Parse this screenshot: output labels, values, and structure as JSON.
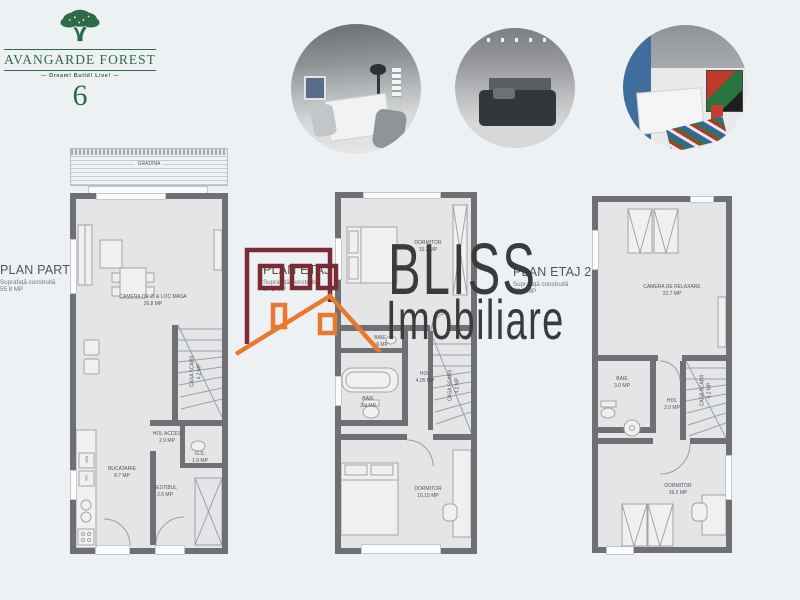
{
  "brand": {
    "name": "AVANGARDE FOREST",
    "tagline": "Dream! Build! Live!",
    "number": "6"
  },
  "watermark": {
    "title": "BLISS",
    "subtitle": "Imobiliare"
  },
  "photos": [
    {
      "alt": "living-room"
    },
    {
      "alt": "bedroom"
    },
    {
      "alt": "kids-bedroom"
    }
  ],
  "plans": [
    {
      "title": "PLAN PARTER",
      "subtitle": "Suprafață construită",
      "area": "55.8 MP",
      "garden": "GRADINA",
      "appliances": [
        "WM",
        "WV"
      ],
      "rooms": [
        {
          "label": "CAMERA DE ZI & LOC MASA",
          "area": "26.8 MP"
        },
        {
          "label": "CASA SCARII",
          "area": "4.2 MP"
        },
        {
          "label": "HOL ACCES",
          "area": "2.9 MP"
        },
        {
          "label": "G.S.",
          "area": "1.9 MP"
        },
        {
          "label": "BUCATARIE",
          "area": "8.7 MP"
        },
        {
          "label": "VESTIBUL",
          "area": "2.6 MP"
        }
      ]
    },
    {
      "title": "PLAN ETAJ 1",
      "subtitle": "Suprafață construită",
      "area": "57.2 MP",
      "rooms": [
        {
          "label": "DORMITOR",
          "area": "15.2 MP"
        },
        {
          "label": "BAIE",
          "area": "3.6 MP"
        },
        {
          "label": "HOL",
          "area": "4.05 MP"
        },
        {
          "label": "BAIE",
          "area": "3.9 MP"
        },
        {
          "label": "CASA SCARII",
          "area": "4.2 MP"
        },
        {
          "label": "DORMITOR",
          "area": "16.15 MP"
        }
      ]
    },
    {
      "title": "PLAN ETAJ 2",
      "subtitle": "Suprafață construită",
      "area": "57.2 MP",
      "rooms": [
        {
          "label": "CAMERA DE RELAXARE",
          "area": "22.7 MP"
        },
        {
          "label": "BAIE",
          "area": "3.0 MP"
        },
        {
          "label": "HOL",
          "area": "2.0 MP"
        },
        {
          "label": "CASA SCARII",
          "area": "4.2 MP"
        },
        {
          "label": "DORMITOR",
          "area": "16.2 MP"
        }
      ]
    }
  ],
  "colors": {
    "brand_green": "#2e6b45",
    "wall": "#6e7073",
    "floor": "#e4e5e7",
    "logo_maroon": "#7b2b33",
    "logo_orange": "#e87a2f",
    "watermark_text": "#3a3b3d"
  }
}
